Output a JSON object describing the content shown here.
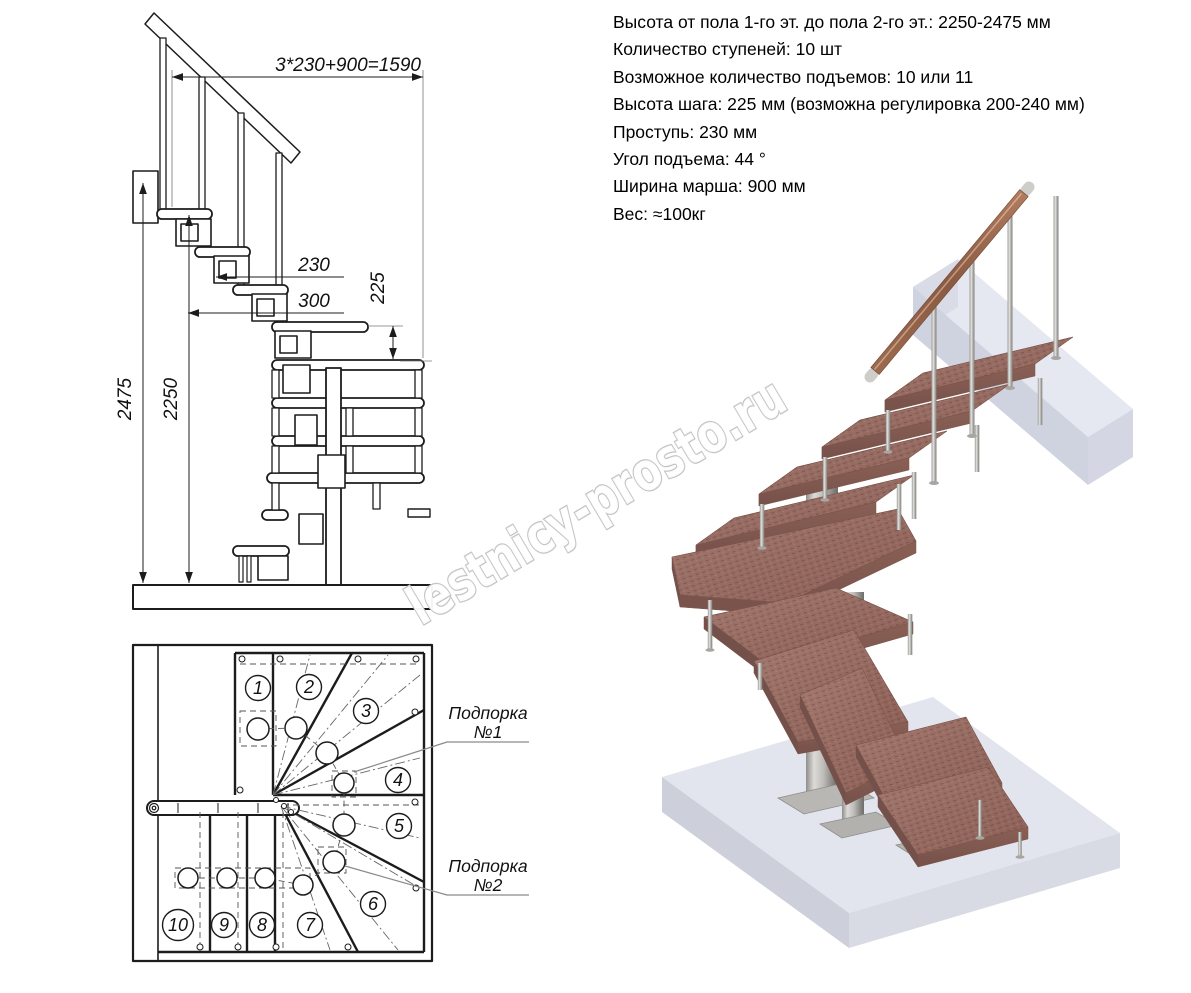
{
  "specs": {
    "lines": [
      "Высота от пола 1-го эт. до пола 2-го эт.: 2250-2475 мм",
      "Количество ступеней: 10 шт",
      "Возможное количество подъемов: 10 или 11",
      "Высота шага: 225 мм (возможна регулировка 200-240 мм)",
      "Проступь: 230 мм",
      "Угол подъема: 44 °",
      "Ширина марша: 900 мм",
      "Вес: ≈100кг"
    ]
  },
  "elevation": {
    "dim_total": "3*230+900=1590",
    "dim_tread": "230",
    "dim_depth": "300",
    "dim_rise": "225",
    "dim_height_full": "2475",
    "dim_height_floor": "2250"
  },
  "plan": {
    "steps": [
      "1",
      "2",
      "3",
      "4",
      "5",
      "6",
      "7",
      "8",
      "9",
      "10"
    ],
    "support1": {
      "line1": "Подпорка",
      "line2": "№1"
    },
    "support2": {
      "line1": "Подпорка",
      "line2": "№2"
    }
  },
  "watermark": {
    "text": "lestnicy-prosto.ru"
  },
  "colors": {
    "line": "#1c1c1c",
    "wood_top": "#9a7068",
    "wood_edge": "#7f574e",
    "metal": "#c6c4c1",
    "slab": "#e3e5ee",
    "watermark_outline": "#c5c5c5"
  }
}
